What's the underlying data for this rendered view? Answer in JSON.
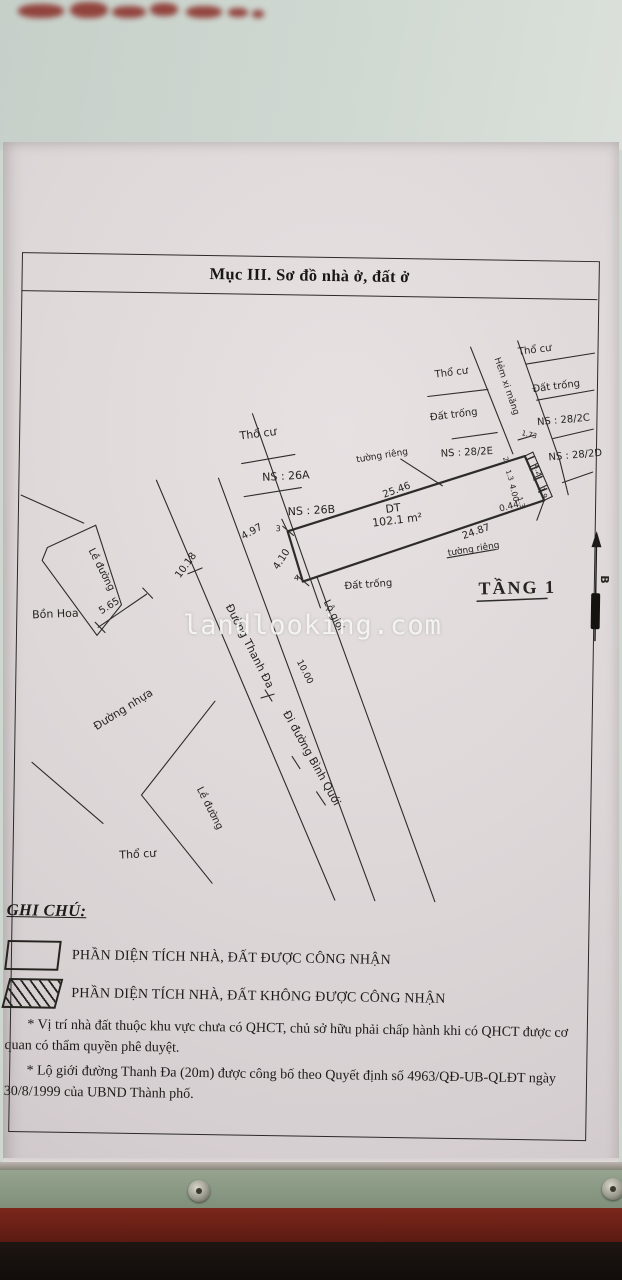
{
  "watermark": "landlooking.com",
  "colors": {
    "paper": "#ded8d9",
    "ink": "#2c2a28",
    "photo_top": "#cdd6cf",
    "frame_green": "#8b9a84",
    "frame_red": "#6e2218"
  },
  "document": {
    "title": "Mục III. Sơ đồ nhà ở, đất ở",
    "map": {
      "parcel": {
        "area_label": "DT",
        "area_value": "102.1 m²",
        "top_edge": "25.46",
        "bottom_edge": "24.87",
        "front_edge": "4.10",
        "adjacent_frontage": "4.97",
        "alley_chain": [
          "1.73",
          "2",
          "1.3",
          "4.00",
          "1.3",
          "4.2",
          "1.9",
          "0.44"
        ],
        "floor": "TẦNG 1"
      },
      "roads": {
        "main": "Đường Thanh Đa",
        "direction": "Đi đường Bình Quới",
        "alley": "Hẻm xi măng",
        "widths": [
          "10.00",
          "10.18"
        ],
        "sidewalk": "Lề đường",
        "surface": "Đường nhựa",
        "setback": "Lộ giới"
      },
      "labels": [
        {
          "id": "tho-cu-upper",
          "t": "Thổ cư",
          "x": 243,
          "y": 436,
          "r": -8,
          "s": 11
        },
        {
          "id": "ns-26a",
          "t": "NS : 26A",
          "x": 266,
          "y": 477,
          "r": -4,
          "s": 11
        },
        {
          "id": "ns-26b",
          "t": "NS : 26B",
          "x": 292,
          "y": 511,
          "r": -4,
          "s": 11
        },
        {
          "id": "tuong-rieng-1",
          "t": "tường riêng",
          "x": 360,
          "y": 457,
          "r": -10,
          "s": 9
        },
        {
          "id": "dim-25-46",
          "t": "25.46",
          "x": 388,
          "y": 492,
          "r": -21,
          "s": 10
        },
        {
          "id": "dt",
          "t": "DT",
          "x": 390,
          "y": 507,
          "r": -8,
          "s": 11
        },
        {
          "id": "area",
          "t": "102.1 m²",
          "x": 377,
          "y": 521,
          "r": -8,
          "s": 11
        },
        {
          "id": "dim-24-87",
          "t": "24.87",
          "x": 468,
          "y": 532,
          "r": -20,
          "s": 10
        },
        {
          "id": "tuong-rieng-2",
          "t": "tường riêng",
          "x": 453,
          "y": 549,
          "r": -10,
          "s": 9
        },
        {
          "id": "tang-1",
          "t": "TẦNG 1",
          "x": 484,
          "y": 587,
          "r": -2,
          "s": 18,
          "f": "serif",
          "w": 600,
          "ls": 2
        },
        {
          "id": "dat-trong-mid",
          "t": "Đất trống",
          "x": 350,
          "y": 584,
          "r": -5,
          "s": 10
        },
        {
          "id": "tho-cu-ne",
          "t": "Thổ cư",
          "x": 520,
          "y": 347,
          "r": -8,
          "s": 10
        },
        {
          "id": "tho-cu-alley-left",
          "t": "Thổ cư",
          "x": 437,
          "y": 371,
          "r": -8,
          "s": 10
        },
        {
          "id": "dat-trong-ne",
          "t": "Đất trống",
          "x": 535,
          "y": 384,
          "r": -8,
          "s": 10
        },
        {
          "id": "dat-trong-alley-left",
          "t": "Đất trống",
          "x": 433,
          "y": 414,
          "r": -8,
          "s": 10
        },
        {
          "id": "ns-28-2c",
          "t": "NS : 28/2C",
          "x": 540,
          "y": 417,
          "r": -6,
          "s": 10
        },
        {
          "id": "ns-28-2e",
          "t": "NS : 28/2E",
          "x": 444,
          "y": 450,
          "r": -4,
          "s": 10
        },
        {
          "id": "ns-28-2d",
          "t": "NS : 28/2D",
          "x": 552,
          "y": 452,
          "r": -6,
          "s": 10
        },
        {
          "id": "hem-xi-mang",
          "t": "Hẻm xi măng",
          "x": 496,
          "y": 351,
          "r": 70,
          "s": 9
        },
        {
          "id": "dim-1-73",
          "t": "1.73",
          "x": 524,
          "y": 427,
          "r": 12,
          "s": 7
        },
        {
          "id": "dim-2",
          "t": "2",
          "x": 506,
          "y": 450,
          "r": 70,
          "s": 7
        },
        {
          "id": "dim-1-3a",
          "t": "1.3",
          "x": 509,
          "y": 463,
          "r": 70,
          "s": 7
        },
        {
          "id": "dim-4-00",
          "t": "4.00",
          "x": 513,
          "y": 477,
          "r": 75,
          "s": 8
        },
        {
          "id": "dim-1-3b",
          "t": "1.3",
          "x": 521,
          "y": 490,
          "r": 70,
          "s": 7
        },
        {
          "id": "dim-4-2",
          "t": "4.2",
          "x": 537,
          "y": 457,
          "r": 70,
          "s": 7
        },
        {
          "id": "dim-1-9",
          "t": "1.9",
          "x": 543,
          "y": 480,
          "r": 70,
          "s": 7
        },
        {
          "id": "dim-0-44",
          "t": "0.44",
          "x": 504,
          "y": 504,
          "r": -15,
          "s": 9
        },
        {
          "id": "dim-4-97",
          "t": "4.97",
          "x": 248,
          "y": 536,
          "r": -30,
          "s": 10
        },
        {
          "id": "tick-3",
          "t": "3",
          "x": 280,
          "y": 527,
          "r": 0,
          "s": 8
        },
        {
          "id": "dim-4-10",
          "t": "4.10",
          "x": 283,
          "y": 566,
          "r": -58,
          "s": 10
        },
        {
          "id": "tick-4",
          "t": "4",
          "x": 299,
          "y": 576,
          "r": 0,
          "s": 8
        },
        {
          "id": "le-duong-1",
          "t": "Lề đường",
          "x": 93,
          "y": 549,
          "r": 62,
          "s": 10
        },
        {
          "id": "bon-hoa",
          "t": "Bồn Hoa",
          "x": 38,
          "y": 618,
          "r": -3,
          "s": 11
        },
        {
          "id": "dim-5-65",
          "t": "5.65",
          "x": 107,
          "y": 613,
          "r": -33,
          "s": 10
        },
        {
          "id": "dim-10-18",
          "t": "10.18",
          "x": 185,
          "y": 576,
          "r": -55,
          "s": 10
        },
        {
          "id": "duong-thanh-da",
          "t": "Đường Thanh Đa",
          "x": 231,
          "y": 603,
          "r": 62,
          "s": 11
        },
        {
          "id": "dim-10-00",
          "t": "10.00",
          "x": 303,
          "y": 657,
          "r": 62,
          "s": 9
        },
        {
          "id": "lo-gioi",
          "t": "Lộ giới",
          "x": 329,
          "y": 597,
          "r": 62,
          "s": 10
        },
        {
          "id": "di-duong-binh-quoi",
          "t": "Đi đường Bình Quới",
          "x": 290,
          "y": 709,
          "r": 60,
          "s": 11
        },
        {
          "id": "duong-nhua",
          "t": "Đường nhựa",
          "x": 104,
          "y": 729,
          "r": -33,
          "s": 11
        },
        {
          "id": "le-duong-2",
          "t": "Lề đường",
          "x": 205,
          "y": 786,
          "r": 62,
          "s": 10
        },
        {
          "id": "tho-cu-sw",
          "t": "Thổ cư",
          "x": 129,
          "y": 857,
          "r": -4,
          "s": 11
        },
        {
          "id": "north-b",
          "t": "B",
          "x": 606,
          "y": 566,
          "r": 90,
          "s": 11,
          "w": 700
        }
      ]
    },
    "legend": {
      "heading": "GHI CHÚ:",
      "items": [
        {
          "swatch": "blank",
          "label": "PHẦN DIỆN TÍCH NHÀ, ĐẤT ĐƯỢC CÔNG NHẬN"
        },
        {
          "swatch": "hatched",
          "label": "PHẦN DIỆN TÍCH NHÀ, ĐẤT KHÔNG ĐƯỢC CÔNG NHẬN"
        }
      ]
    },
    "notes": [
      "* Vị trí nhà đất thuộc khu vực chưa có QHCT, chủ sở hữu phải chấp hành khi có QHCT được cơ quan có thẩm quyền phê duyệt.",
      "* Lộ giới đường Thanh Đa (20m) được công bố theo Quyết định số 4963/QĐ-UB-QLĐT ngày 30/8/1999 của UBND Thành phố."
    ]
  }
}
